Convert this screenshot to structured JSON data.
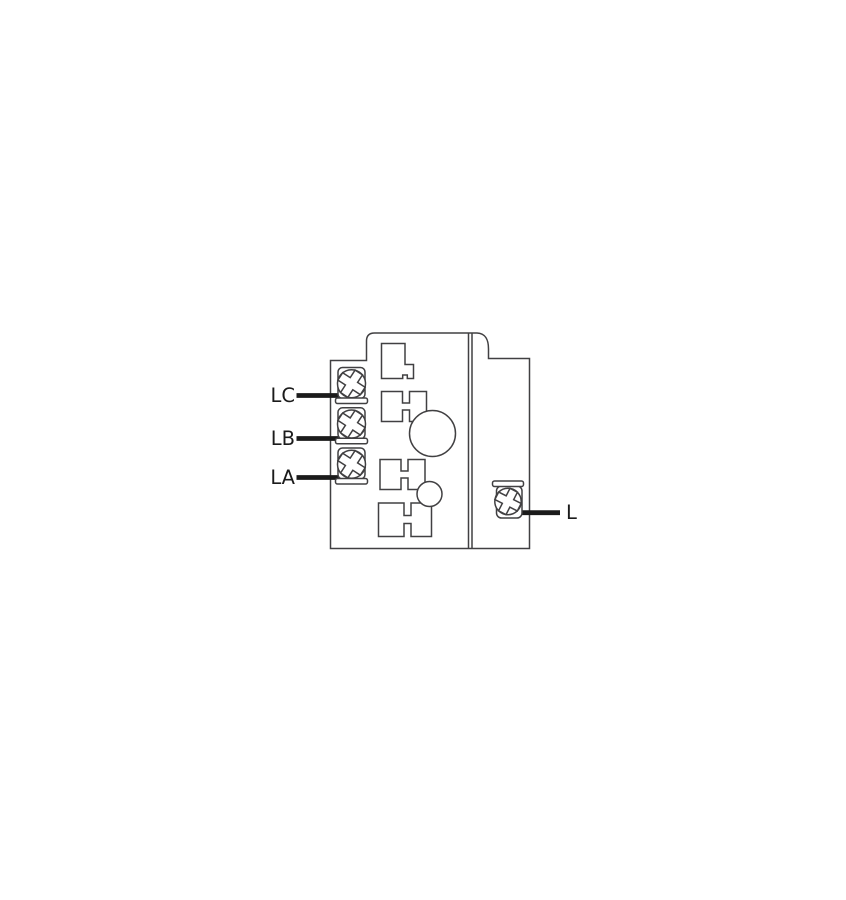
{
  "diagram": {
    "type": "wiring-terminal-diagram",
    "description": "Terminal block outline drawing with three screw terminals on the left and one screw terminal on the right",
    "terminal_labels": {
      "lc": "LC",
      "lb": "LB",
      "la": "LA",
      "l": "L"
    },
    "terminals": [
      {
        "id": "LC",
        "side": "left"
      },
      {
        "id": "LB",
        "side": "left"
      },
      {
        "id": "LA",
        "side": "left"
      },
      {
        "id": "L",
        "side": "right"
      }
    ],
    "colors": {
      "background": "#ffffff",
      "outline": "#414042",
      "lead_line": "#1b1b1b",
      "label_text": "#1b1b1b"
    }
  }
}
